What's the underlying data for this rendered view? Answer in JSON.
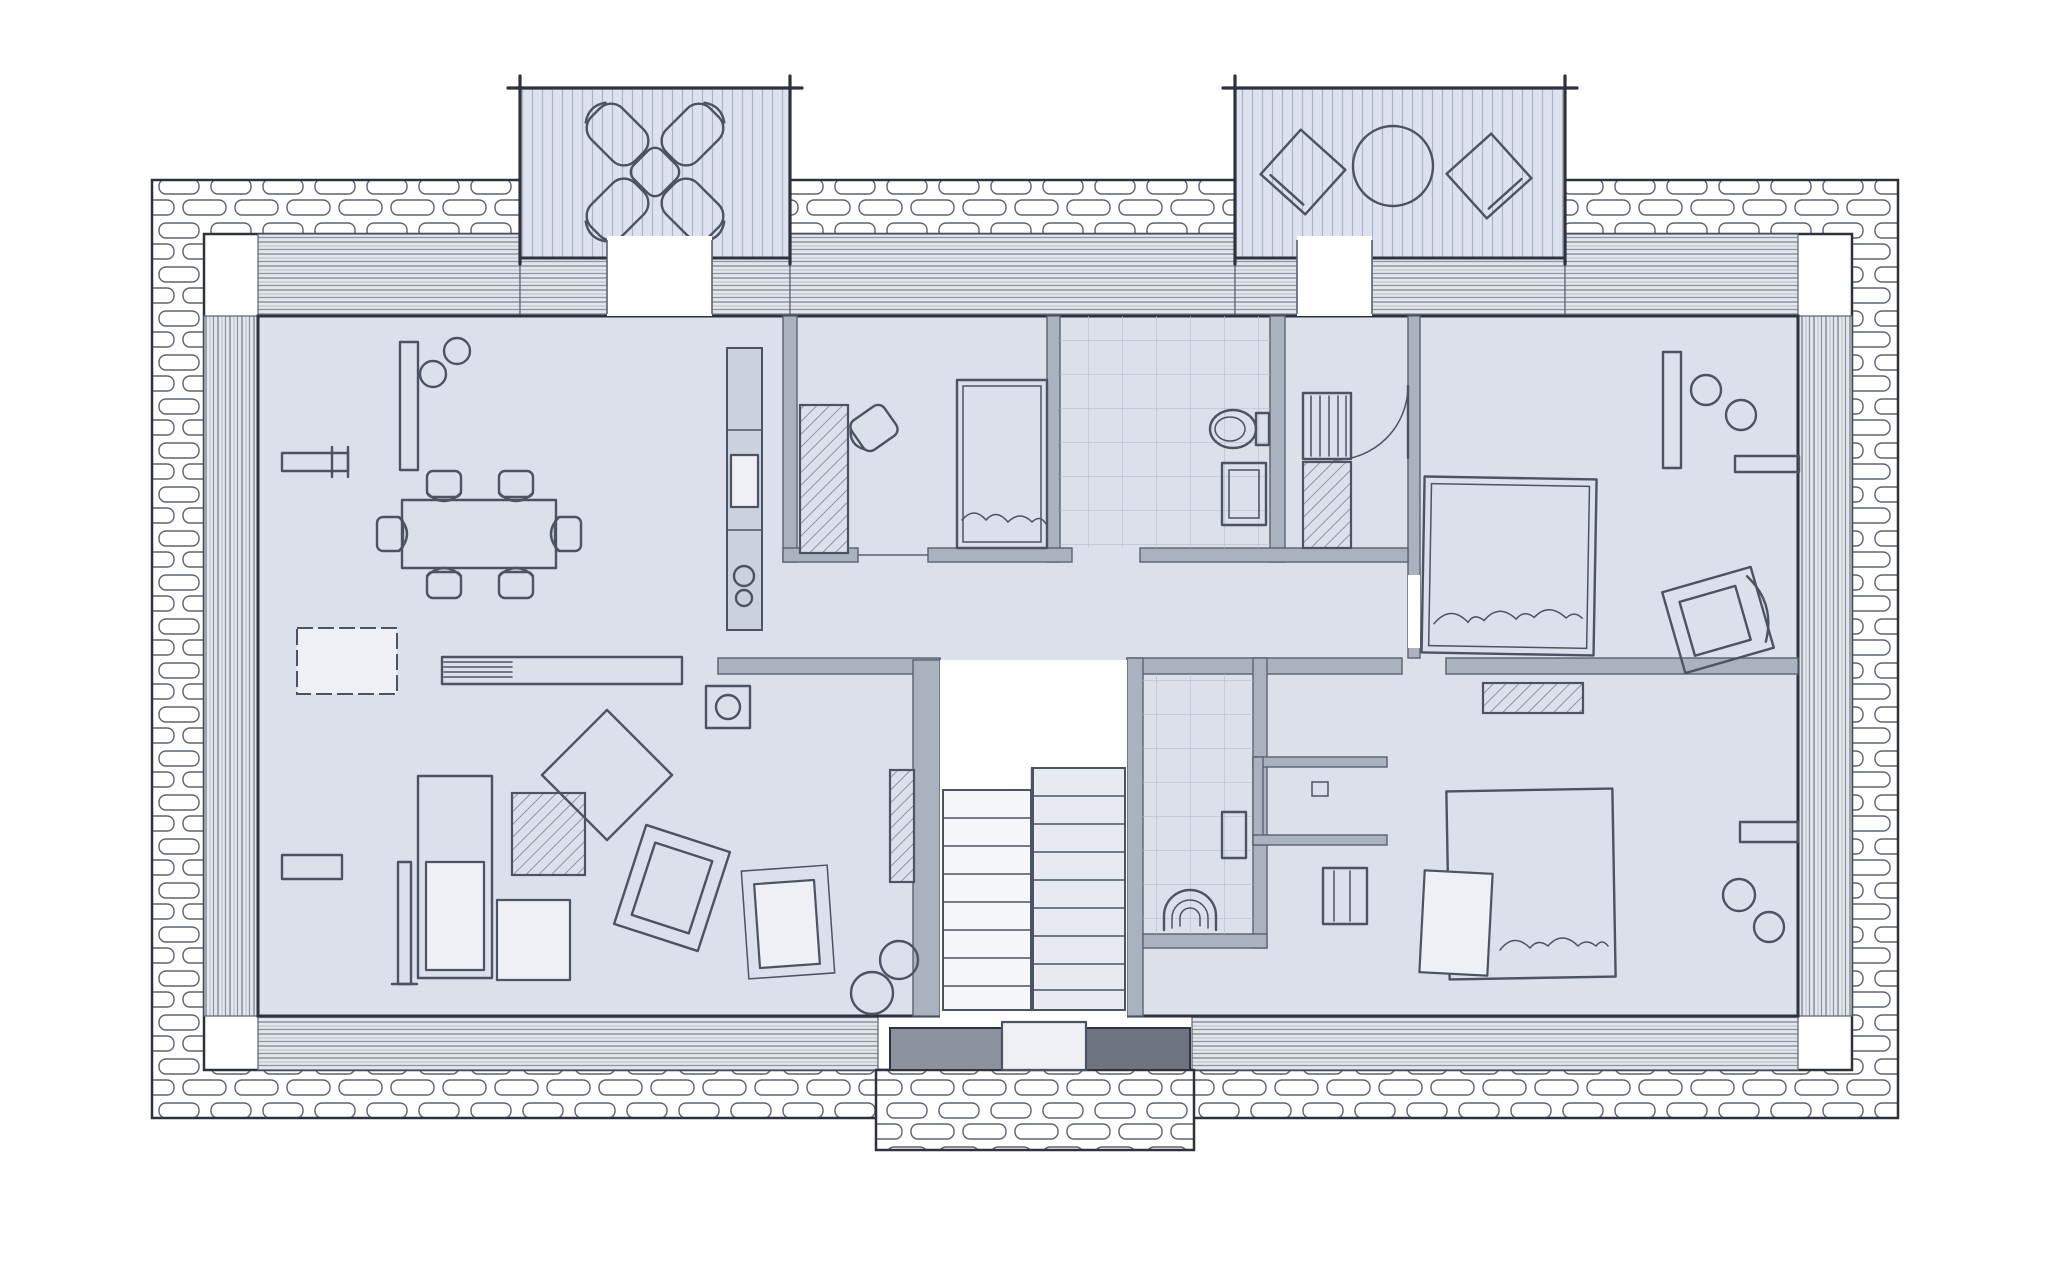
{
  "meta": {
    "title": "Hand-drawn architectural floor plan sketch",
    "style": "pencil sketch, top-down plan view",
    "storey": "single floor with central staircase and street-side entrance porch"
  },
  "palette": {
    "paper": "#ffffff",
    "ink": "#2e323c",
    "wall_fill": "#aab1bf",
    "wall_edge": "#5a6170",
    "floor": "#dce0ea",
    "floor_bright": "#eef0f5",
    "band_base": "#e3e6ec",
    "band_line_dark": "#8d939f",
    "band_line_mid": "#c6cad3",
    "deck": "#dde2ee",
    "deck_line": "#aab4c9",
    "furniture": "#4c5362",
    "hatch": "#7b8290",
    "tile": "#b9c0cd",
    "step_dark": "#8b919d",
    "step_darker": "#6e747f",
    "stone": "#5c626e"
  },
  "building": {
    "perimeter": "rubble-stone band around full rectangle with window strips on all four sides",
    "balconies": [
      {
        "id": "balcony-left",
        "position": "top-left",
        "furniture": "four lounge chairs arranged in an X around a small table",
        "decking": "vertical plank lines"
      },
      {
        "id": "balcony-right",
        "position": "top-right",
        "furniture": "round table with two angled square chairs",
        "decking": "vertical plank lines"
      }
    ],
    "rooms": [
      {
        "id": "living-dining",
        "position": "left half",
        "furniture": [
          "wall shelf",
          "tall sideboard with two plants",
          "dining table with six chairs",
          "white rug",
          "long striped sideboard",
          "kitchen counter with sink and hob",
          "stove/fireplace box",
          "media niche",
          "floor lamp",
          "sofa",
          "hatched coffee table",
          "square seat",
          "diamond side table",
          "rotated armchair",
          "lounge chair on rug",
          "two stools",
          "small bench"
        ]
      },
      {
        "id": "guest-bedroom",
        "position": "top-center-left",
        "furniture": [
          "hatched desk",
          "desk chair",
          "single bed with pillow"
        ]
      },
      {
        "id": "bathroom",
        "position": "top-center-right",
        "furniture": [
          "tiled floor",
          "toilet",
          "washbasin"
        ]
      },
      {
        "id": "hall-closet",
        "position": "center",
        "furniture": [
          "closet rail",
          "hatched shelf",
          "door swing arc"
        ]
      },
      {
        "id": "bedroom-top-right",
        "position": "top-right",
        "furniture": [
          "double bed with pillows",
          "tall wardrobe",
          "two plants",
          "wall shelf",
          "rotated armchair",
          "entry door"
        ]
      },
      {
        "id": "wc-shower",
        "position": "center, right of stairs",
        "furniture": [
          "tiled floor",
          "arched shower/basin",
          "wall fixture"
        ]
      },
      {
        "id": "dressing-room",
        "position": "center-right",
        "furniture": [
          "U-shaped partition walls",
          "small marker"
        ]
      },
      {
        "id": "bedroom-bottom-right",
        "position": "bottom-right",
        "furniture": [
          "double bed with white pillow",
          "hatched bedside rug",
          "cabinet",
          "wall shelf",
          "two stools"
        ]
      }
    ],
    "staircase": {
      "id": "stairwell",
      "position": "bottom-center",
      "flights": 2,
      "treads_per_flight": 8,
      "note": "white stairwell cut-out between hall and entrance"
    },
    "entrance": {
      "id": "porch",
      "position": "bottom-center",
      "elements": [
        "stone paved porch apron",
        "left step block",
        "right step block",
        "center door mat"
      ]
    }
  }
}
